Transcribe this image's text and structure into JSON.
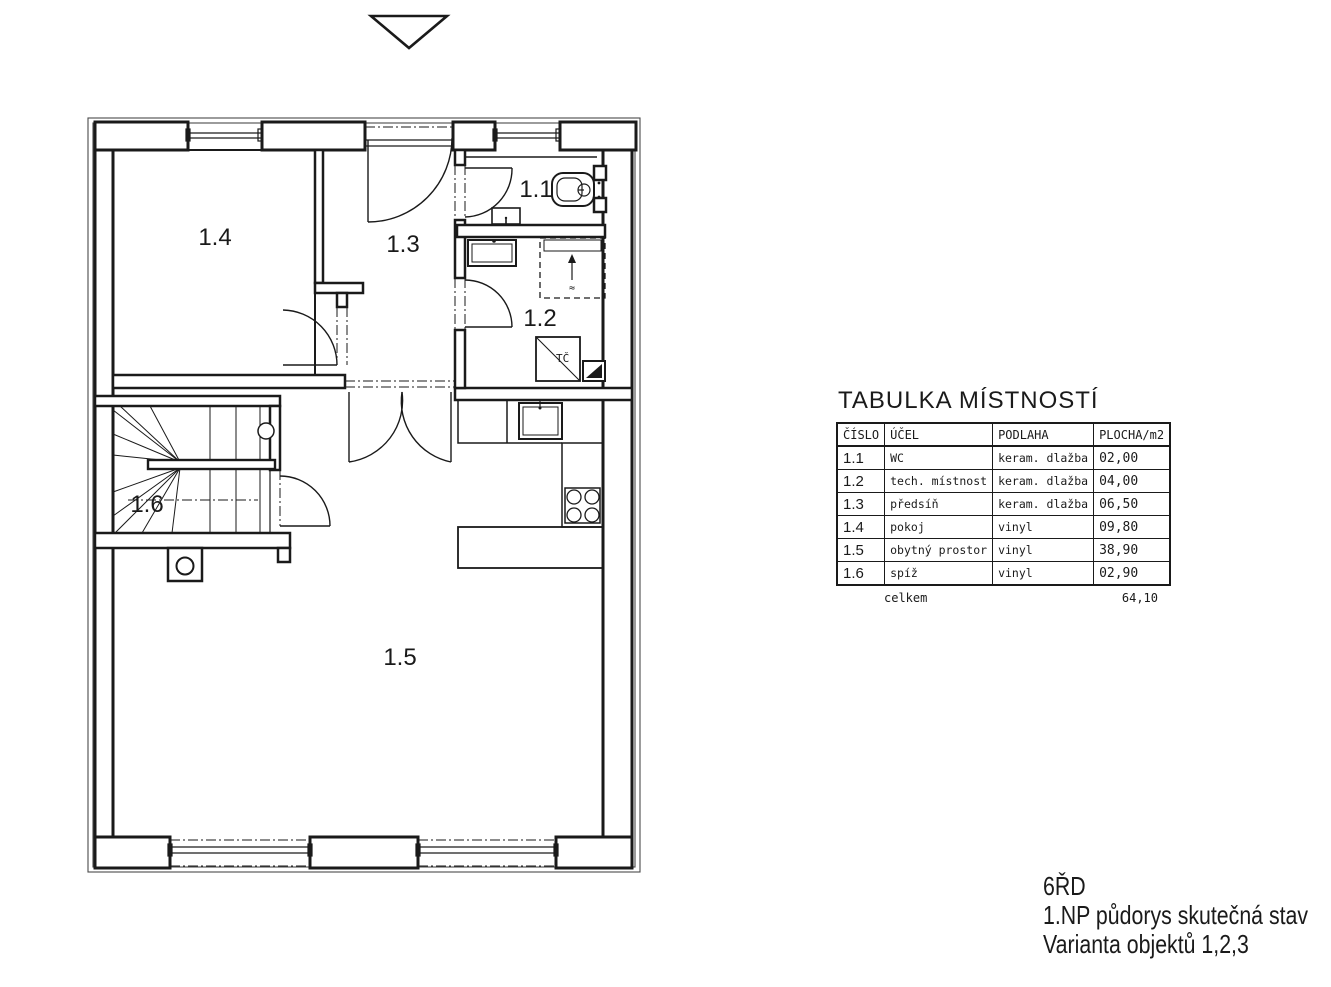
{
  "plan": {
    "rooms": [
      {
        "id": "1.1",
        "label": "1.1"
      },
      {
        "id": "1.2",
        "label": "1.2"
      },
      {
        "id": "1.3",
        "label": "1.3"
      },
      {
        "id": "1.4",
        "label": "1.4"
      },
      {
        "id": "1.5",
        "label": "1.5"
      },
      {
        "id": "1.6",
        "label": "1.6"
      }
    ],
    "fixtures": {
      "heat_pump_label": "TČ",
      "washer_mark": "≈"
    },
    "colors": {
      "line": "#1a1a1a"
    }
  },
  "table": {
    "title": "TABULKA MÍSTNOSTÍ",
    "headers": [
      "ČÍSLO",
      "ÚČEL",
      "PODLAHA",
      "PLOCHA/m2"
    ],
    "rows": [
      {
        "cislo": "1.1",
        "ucel": "WC",
        "podlaha": "keram. dlažba",
        "plocha": "02,00"
      },
      {
        "cislo": "1.2",
        "ucel": "tech. místnost",
        "podlaha": "keram. dlažba",
        "plocha": "04,00"
      },
      {
        "cislo": "1.3",
        "ucel": "předsíň",
        "podlaha": "keram. dlažba",
        "plocha": "06,50"
      },
      {
        "cislo": "1.4",
        "ucel": "pokoj",
        "podlaha": "vinyl",
        "plocha": "09,80"
      },
      {
        "cislo": "1.5",
        "ucel": "obytný prostor",
        "podlaha": "vinyl",
        "plocha": "38,90"
      },
      {
        "cislo": "1.6",
        "ucel": "spíž",
        "podlaha": "vinyl",
        "plocha": "02,90"
      }
    ],
    "total_label": "celkem",
    "total_value": "64,10"
  },
  "titleblock": {
    "line1": "6ŘD",
    "line2": "1.NP půdorys skutečná stav",
    "line3": "Varianta objektů 1,2,3"
  }
}
